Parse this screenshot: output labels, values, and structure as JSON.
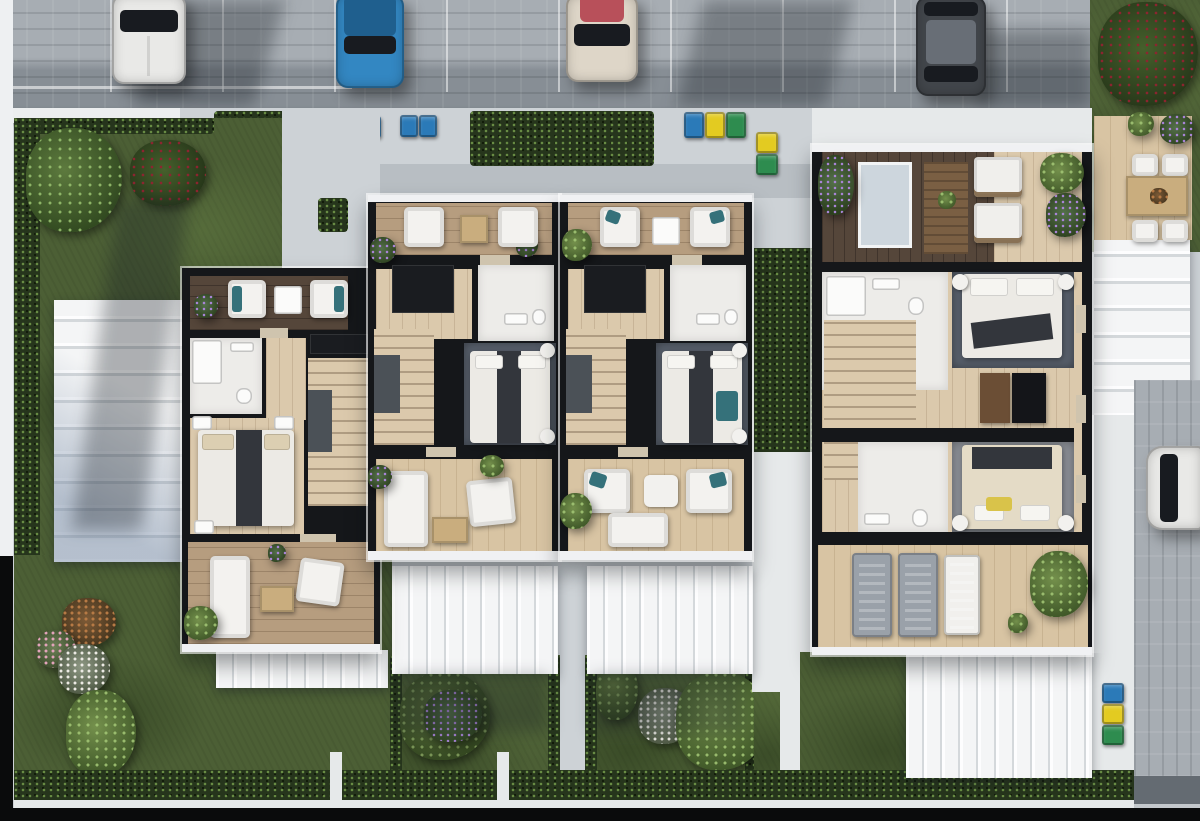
{
  "scene": {
    "kind": "aerial-3d-floorplan-render",
    "description": "Top-down architectural rendering of a row of four residential units with cut-away upper floor plans, front parking street with four cars, recycling bins, white pergolas, rear lawns and gardens, and a side street with one parked car.",
    "visible_text": ""
  },
  "palette": {
    "concrete": "#cdd2d6",
    "concreteDark": "#b8bec3",
    "walkWhite": "#e6e9ea",
    "sidewalk": "#eceeef",
    "roadPaver": "#a7adb3",
    "roadPaverDark": "#878e95",
    "lawn": "#4c5f35",
    "hedge": "#26351c",
    "wallBlack": "#15171a",
    "woodLight": "#dbc9ac",
    "woodMed": "#b69d7f",
    "woodDark": "#55463a",
    "woodDeck": "#d8c4a3",
    "floorWhite": "#edece9",
    "rugGrey": "#59616d",
    "rugGreyLight": "#8b8f96",
    "bedWhite": "#eceae5",
    "runnerDark": "#33363c",
    "teal": "#35717a",
    "pergola": "#f4f5f6",
    "pergolaLine": "#d4d8db",
    "carWhite": "#e9e9e7",
    "carBlue": "#3387c2",
    "carCream": "#ded6c8",
    "carDark": "#42464b",
    "binBlue": "#2b7ab8",
    "binYellow": "#e3cb21",
    "binGreen": "#2e8c4f",
    "flowerPurple": "#a884d6",
    "flowerPink": "#e3a4bb",
    "flowerRed": "#8d2330",
    "flowerWhite": "#eceae4",
    "bushRust": "#b77a45",
    "tableWood": "#c9ad7e",
    "shadow": "rgba(22,28,34,0.32)"
  },
  "vehicles": [
    {
      "name": "white-car",
      "location": "top-parking-left",
      "color_key": "carWhite"
    },
    {
      "name": "blue-car",
      "location": "top-parking",
      "color_key": "carBlue"
    },
    {
      "name": "cream-car",
      "location": "top-parking-middle",
      "color_key": "carCream"
    },
    {
      "name": "dark-grey-car",
      "location": "top-parking-right",
      "color_key": "carDark"
    },
    {
      "name": "white-car-side",
      "location": "right-street",
      "color_key": "carWhite"
    }
  ],
  "waste_bins": {
    "colors": [
      "blue",
      "yellow",
      "green"
    ],
    "clusters": 5
  },
  "buildings": [
    {
      "name": "unit-1",
      "rooms": [
        "upper-terrace",
        "bathroom",
        "hallway",
        "staircase",
        "bedroom",
        "lower-terrace"
      ]
    },
    {
      "name": "unit-2",
      "rooms": [
        "upper-terrace",
        "wardrobe-hall",
        "bathroom",
        "staircase",
        "bedroom",
        "lower-terrace"
      ]
    },
    {
      "name": "unit-3",
      "rooms": [
        "upper-terrace",
        "wardrobe-hall",
        "bathroom",
        "staircase",
        "bedroom",
        "lower-terrace"
      ]
    },
    {
      "name": "unit-4",
      "rooms": [
        "roof-room",
        "bathroom-north",
        "bedroom-north",
        "staircase",
        "bathroom-south",
        "bedroom-south",
        "lower-terrace"
      ]
    }
  ],
  "outdoor_features": [
    "front-hedges",
    "left-garden",
    "rear-gardens",
    "pergolas",
    "dining-deck",
    "lawn-borders",
    "white-fence"
  ]
}
